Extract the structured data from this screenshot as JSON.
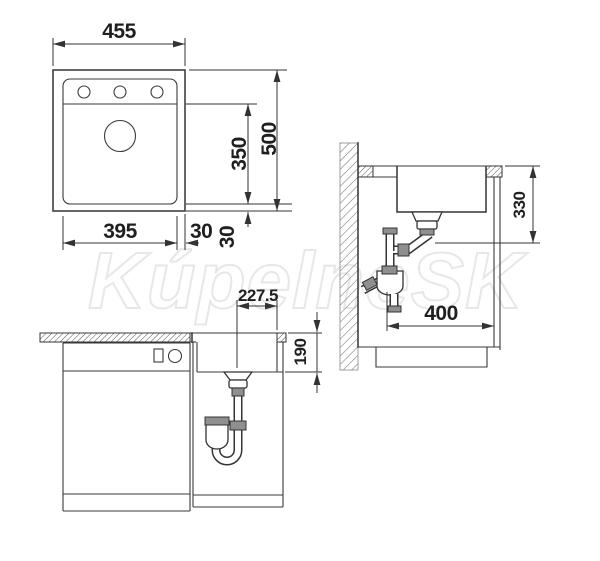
{
  "watermark": {
    "text": "KúpelneSK",
    "color": "#e7e7e7"
  },
  "drawing": {
    "line_color": "#333333",
    "background": "#ffffff"
  },
  "views": {
    "top": {
      "name": "sink top view",
      "dim_width": "455",
      "dim_depth": "500",
      "dim_bowl_depth": "350",
      "dim_bowl_width": "395",
      "dim_rim_right": "30",
      "dim_rim_bottom": "30"
    },
    "side": {
      "name": "cabinet side section",
      "dim_drain_height": "330",
      "dim_depth_front": "400"
    },
    "front": {
      "name": "cabinet front view",
      "dim_drain_offset": "227.5",
      "dim_counter_to_drain": "190"
    }
  }
}
